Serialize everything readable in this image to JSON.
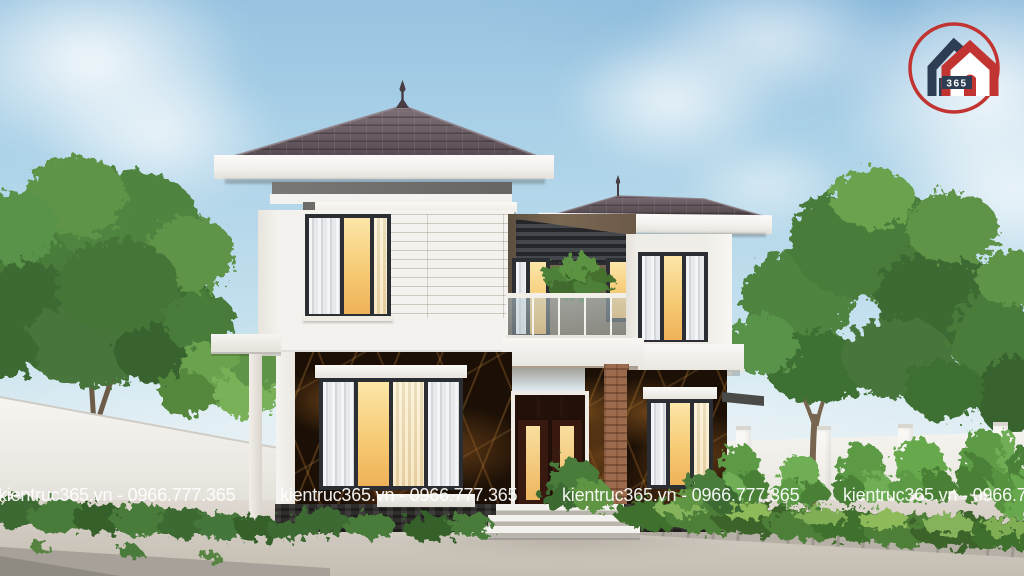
{
  "scene": {
    "subject": "two-story modern house exterior 3D rendering with trees, white boundary walls and paved forecourt"
  },
  "watermark": {
    "text": "kientruc365.vn - 0966.777.365",
    "color": "#ffffff",
    "repeats": 4
  },
  "logo": {
    "badge_text": "365",
    "ring_color": "#c23431",
    "house_left_color": "#2d3e54",
    "house_right_color": "#c23431",
    "badge_bg": "#2d3e54",
    "badge_text_color": "#ffffff"
  },
  "palette": {
    "sky_top": "#97c3e0",
    "sky_horizon": "#eef3f2",
    "roof_tile": "#5d5258",
    "wall_white": "#f3f1ec",
    "frieze_gray": "#716f6c",
    "wood_cladding": "#c3945f",
    "marble_base": "#1c1006",
    "marble_vein": "#b07a38",
    "window_glow": "#f6c870",
    "window_frame": "#2b2f34",
    "brick_pillar": "#9c6a4c",
    "foliage_dark": "#3c6a30",
    "foliage_light": "#6aa24e",
    "pavement": "#cfc8be"
  }
}
